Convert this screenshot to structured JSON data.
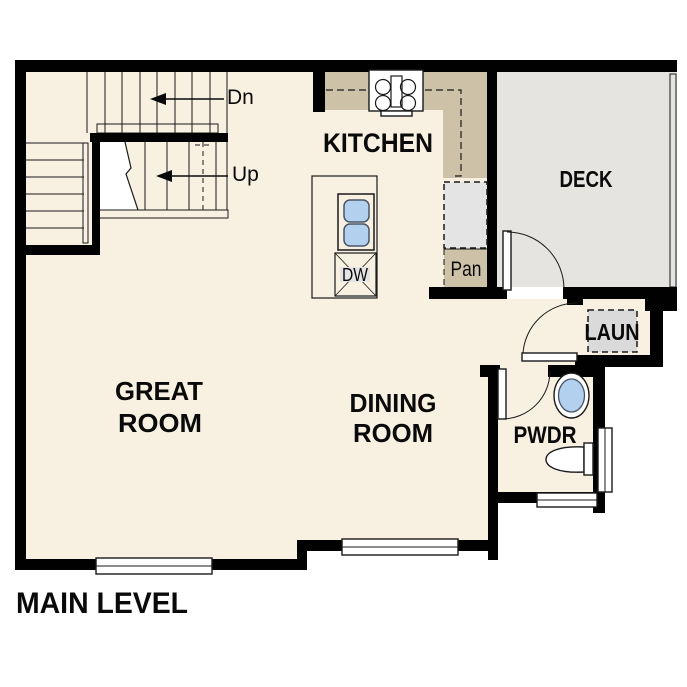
{
  "plan_title": "MAIN LEVEL",
  "labels": {
    "kitchen": "KITCHEN",
    "deck": "DECK",
    "great_room_line1": "GREAT",
    "great_room_line2": "ROOM",
    "dining_room_line1": "DINING",
    "dining_room_line2": "ROOM",
    "laundry": "LAUN",
    "powder": "PWDR",
    "pantry": "Pan",
    "dishwasher": "DW",
    "stairs_down": "Dn",
    "stairs_up": "Up"
  },
  "colors": {
    "floor": "#f8f0e1",
    "counter": "#cdc2a8",
    "deck": "#e5e4e1",
    "appliance": "#e4e4e4",
    "washer": "#dadada",
    "sink": "#b3d0ee",
    "wall": "#010101"
  }
}
